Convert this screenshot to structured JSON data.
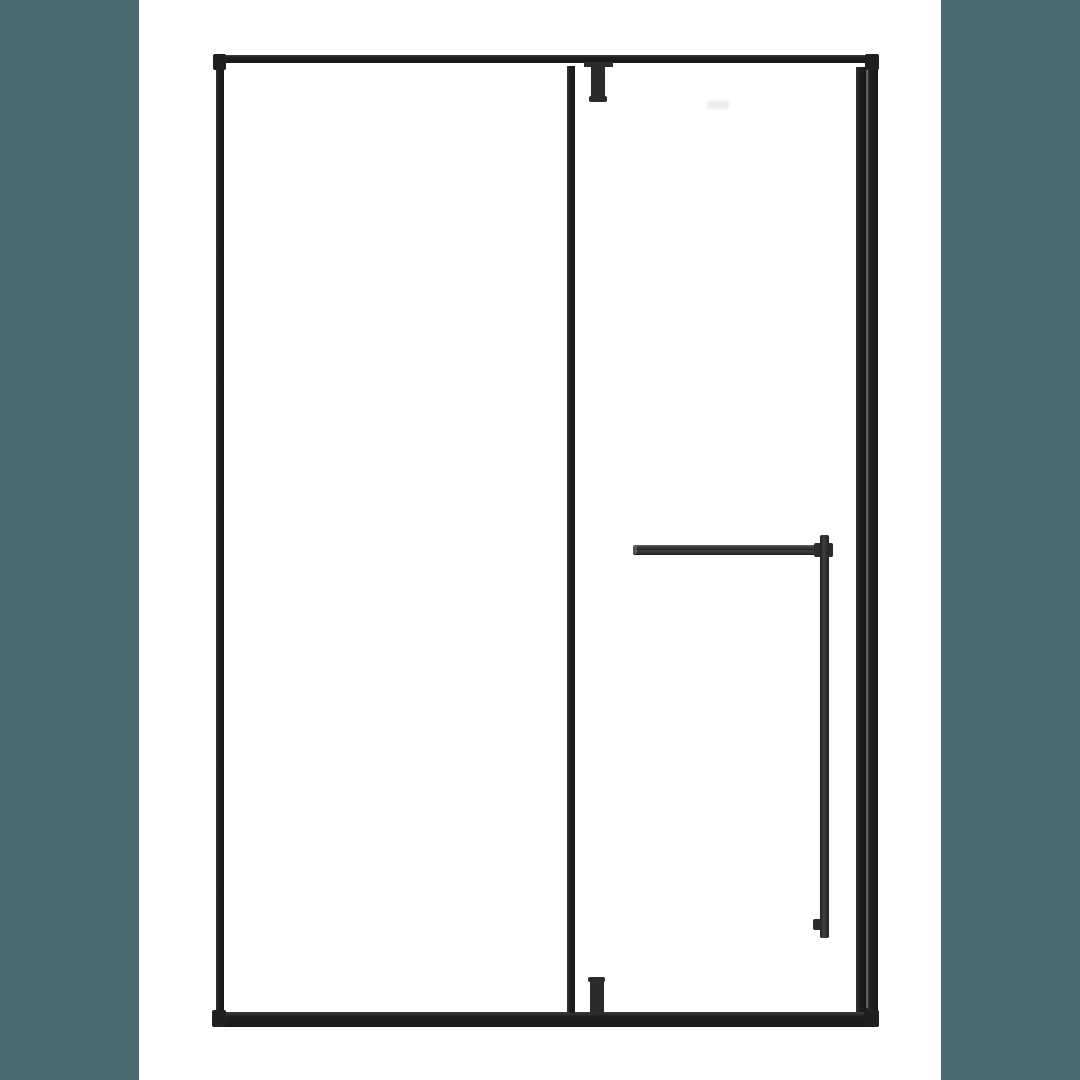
{
  "canvas": {
    "width": 1080,
    "height": 1080,
    "background": "#ffffff"
  },
  "colors": {
    "sidebar": "#4b6970",
    "frame": "#1f1f1f",
    "hardware": "#2b2b2b",
    "glass": "#ffffff",
    "watermark": "#ececec"
  },
  "illustration": {
    "subject": "Framed glass shower door render with matte black hardware and towel bar, flanked by teal side bars",
    "parts": [
      "frame-top-rail",
      "frame-left-stile",
      "frame-right-stile",
      "frame-right-inner-bar",
      "frame-bottom-rail",
      "door-divider-stile",
      "top-pivot-hinge",
      "bottom-pivot-guide",
      "towel-bar-horizontal",
      "towel-bar-vertical"
    ]
  }
}
